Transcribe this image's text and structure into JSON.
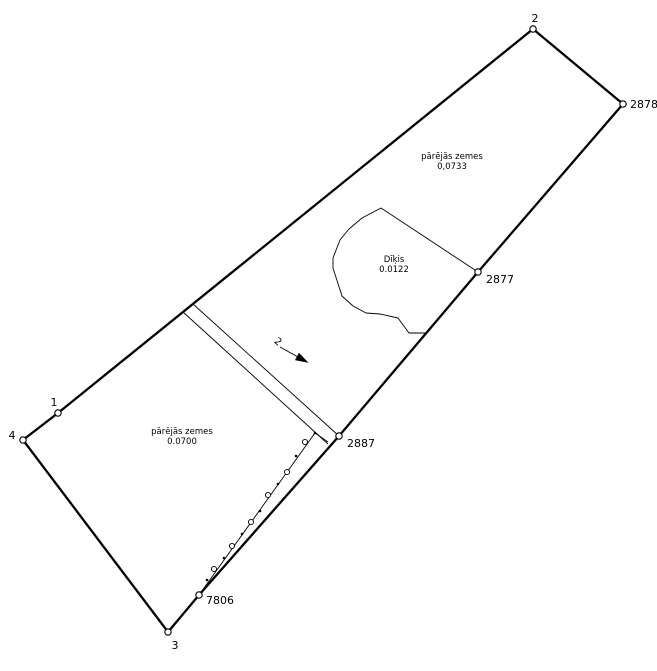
{
  "canvas": {
    "width": 657,
    "height": 671,
    "background": "#ffffff",
    "line_color": "#000000",
    "thick_stroke": 2.3,
    "thin_stroke": 0.9
  },
  "boundary": {
    "ring_order": [
      "2",
      "2878",
      "2877",
      "2887",
      "7806",
      "3",
      "4",
      "1"
    ],
    "marker_radius": 3.2,
    "point_label_font_px": 11,
    "points": [
      {
        "id": "2",
        "x": 533,
        "y": 29,
        "label": "2",
        "lx": 535,
        "ly": 22,
        "anchor": "middle"
      },
      {
        "id": "2878",
        "x": 623,
        "y": 104,
        "label": "2878",
        "lx": 630,
        "ly": 108,
        "anchor": "start"
      },
      {
        "id": "2877",
        "x": 478,
        "y": 272,
        "label": "2877",
        "lx": 486,
        "ly": 283,
        "anchor": "start"
      },
      {
        "id": "2887",
        "x": 339,
        "y": 436,
        "label": "2887",
        "lx": 347,
        "ly": 447,
        "anchor": "start"
      },
      {
        "id": "7806",
        "x": 199,
        "y": 595,
        "label": "7806",
        "lx": 206,
        "ly": 604,
        "anchor": "start"
      },
      {
        "id": "3",
        "x": 168,
        "y": 632,
        "label": "3",
        "lx": 175,
        "ly": 649,
        "anchor": "middle"
      },
      {
        "id": "4",
        "x": 23,
        "y": 440,
        "label": "4",
        "lx": 12,
        "ly": 439,
        "anchor": "middle"
      },
      {
        "id": "1",
        "x": 58,
        "y": 413,
        "label": "1",
        "lx": 54,
        "ly": 406,
        "anchor": "middle"
      }
    ]
  },
  "pond": {
    "outline": [
      [
        381,
        208
      ],
      [
        478,
        272
      ],
      [
        426,
        333
      ],
      [
        409,
        333
      ],
      [
        398,
        318
      ],
      [
        380,
        314
      ],
      [
        366,
        313
      ],
      [
        353,
        306
      ],
      [
        342,
        296
      ],
      [
        333,
        268
      ],
      [
        333,
        258
      ],
      [
        340,
        240
      ],
      [
        349,
        229
      ],
      [
        362,
        218
      ]
    ],
    "label": {
      "line1": "Dīķis",
      "line2": "0.0122",
      "x": 394,
      "y1": 262,
      "y2": 272
    }
  },
  "road": {
    "edges": [
      {
        "x1": 193,
        "y1": 304,
        "x2": 339,
        "y2": 436
      },
      {
        "x1": 183,
        "y1": 312,
        "x2": 328,
        "y2": 444
      }
    ],
    "label": {
      "text": "2",
      "x": 276,
      "y": 344,
      "rotation": 40
    },
    "arrow": {
      "line": {
        "x1": 280,
        "y1": 347,
        "x2": 298,
        "y2": 357
      },
      "head": [
        [
          307,
          362
        ],
        [
          295.7,
          359.8
        ],
        [
          299.1,
          353.6
        ]
      ]
    }
  },
  "fence": {
    "path": [
      [
        328,
        442
      ],
      [
        315,
        433
      ],
      [
        199,
        595
      ]
    ],
    "circles": [
      [
        305,
        442
      ],
      [
        287,
        472
      ],
      [
        268,
        495
      ],
      [
        251,
        522
      ],
      [
        232,
        546
      ],
      [
        214,
        569
      ]
    ],
    "dots": [
      [
        315,
        433
      ],
      [
        296,
        456
      ],
      [
        278,
        484
      ],
      [
        260,
        511
      ],
      [
        242,
        534
      ],
      [
        224,
        558
      ],
      [
        207,
        580
      ]
    ],
    "circle_radius": 2.6,
    "dot_radius": 1.3
  },
  "area_labels": {
    "font_px": 8.5,
    "items": [
      {
        "id": "upper-parcel",
        "line1": "pārējās zemes",
        "line2": "0,0733",
        "x": 452,
        "y1": 159,
        "y2": 169
      },
      {
        "id": "lower-parcel",
        "line1": "pārējās zemes",
        "line2": "0.0700",
        "x": 182,
        "y1": 434,
        "y2": 444
      }
    ]
  }
}
